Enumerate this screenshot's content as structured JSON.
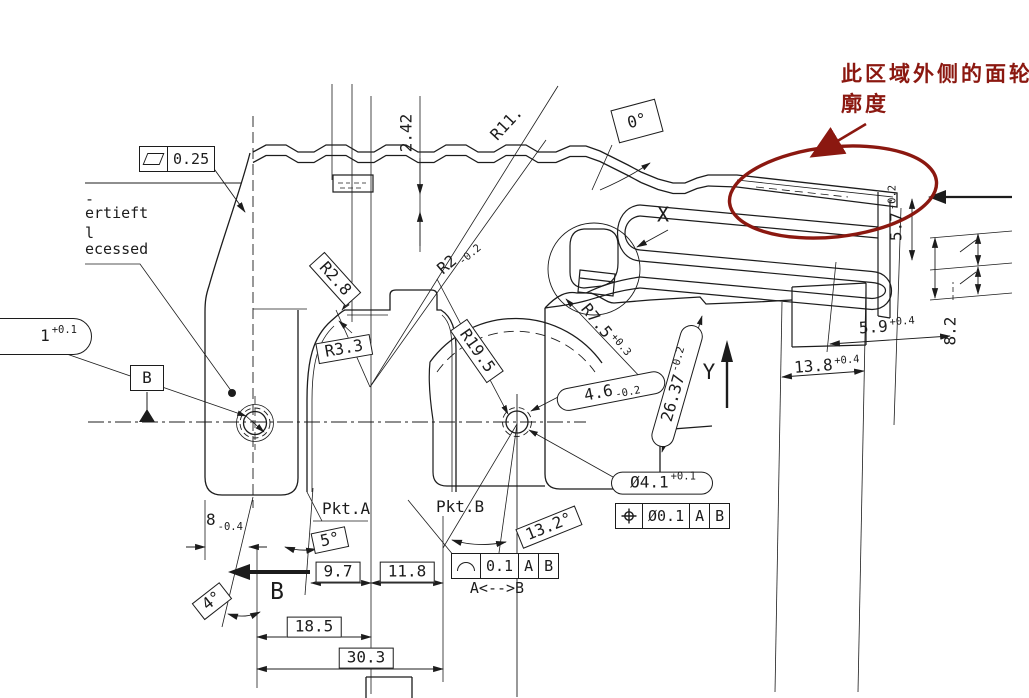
{
  "colors": {
    "ink": "#1c1c1c",
    "annotation": "#8b1810",
    "background": "#ffffff"
  },
  "annotation": {
    "line1": "此区域外侧的面轮",
    "line2": "廓度"
  },
  "notes": {
    "frag_dash": "-",
    "vertieft": "ertieft",
    "frag_l": "l",
    "recessed": "ecessed",
    "pkt_a": "Pkt.A",
    "pkt_b": "Pkt.B",
    "detail_x": "X",
    "axis_y": "Y",
    "view_b": "B",
    "datum_b": "B",
    "ab_note": "A<-->B"
  },
  "fcf": {
    "flatness": {
      "symbol": "flatness",
      "value": "0.25"
    },
    "position": {
      "symbol": "position",
      "value": "Ø0.1",
      "datum1": "A",
      "datum2": "B"
    },
    "profile": {
      "symbol": "profile-of-line",
      "value": "0.1",
      "datum1": "A",
      "datum2": "B"
    }
  },
  "dims": {
    "h242": {
      "v": "2.42"
    },
    "r11": {
      "v": "R11."
    },
    "a0": {
      "v": "0°"
    },
    "d57": {
      "v": "5.7",
      "tol": "-0.2"
    },
    "d82": {
      "v": "8.2"
    },
    "d59": {
      "v": "5.9",
      "tol": "+0.4"
    },
    "d138": {
      "v": "13.8",
      "tol": "+0.4"
    },
    "r75": {
      "v": "R7.5",
      "tol": "+0.3"
    },
    "d46": {
      "v": "4.6",
      "tol": "-0.2"
    },
    "d2637": {
      "v": "26.37",
      "tol": "-0.2"
    },
    "r28": {
      "v": "R2.8"
    },
    "r2": {
      "v": "R2",
      "tol": "-0.2"
    },
    "r33": {
      "v": "R3.3"
    },
    "r195": {
      "v": "R19.5"
    },
    "d1": {
      "v": "1",
      "tol": "+0.1"
    },
    "d8": {
      "v": "8",
      "tol": "-0.4"
    },
    "a5": {
      "v": "5°"
    },
    "a4": {
      "v": "4°"
    },
    "d97": {
      "v": "9.7"
    },
    "d118": {
      "v": "11.8"
    },
    "d185": {
      "v": "18.5"
    },
    "d303": {
      "v": "30.3"
    },
    "d41": {
      "v": "Ø4.1",
      "tol": "+0.1"
    },
    "a132": {
      "v": "13.2°"
    }
  }
}
